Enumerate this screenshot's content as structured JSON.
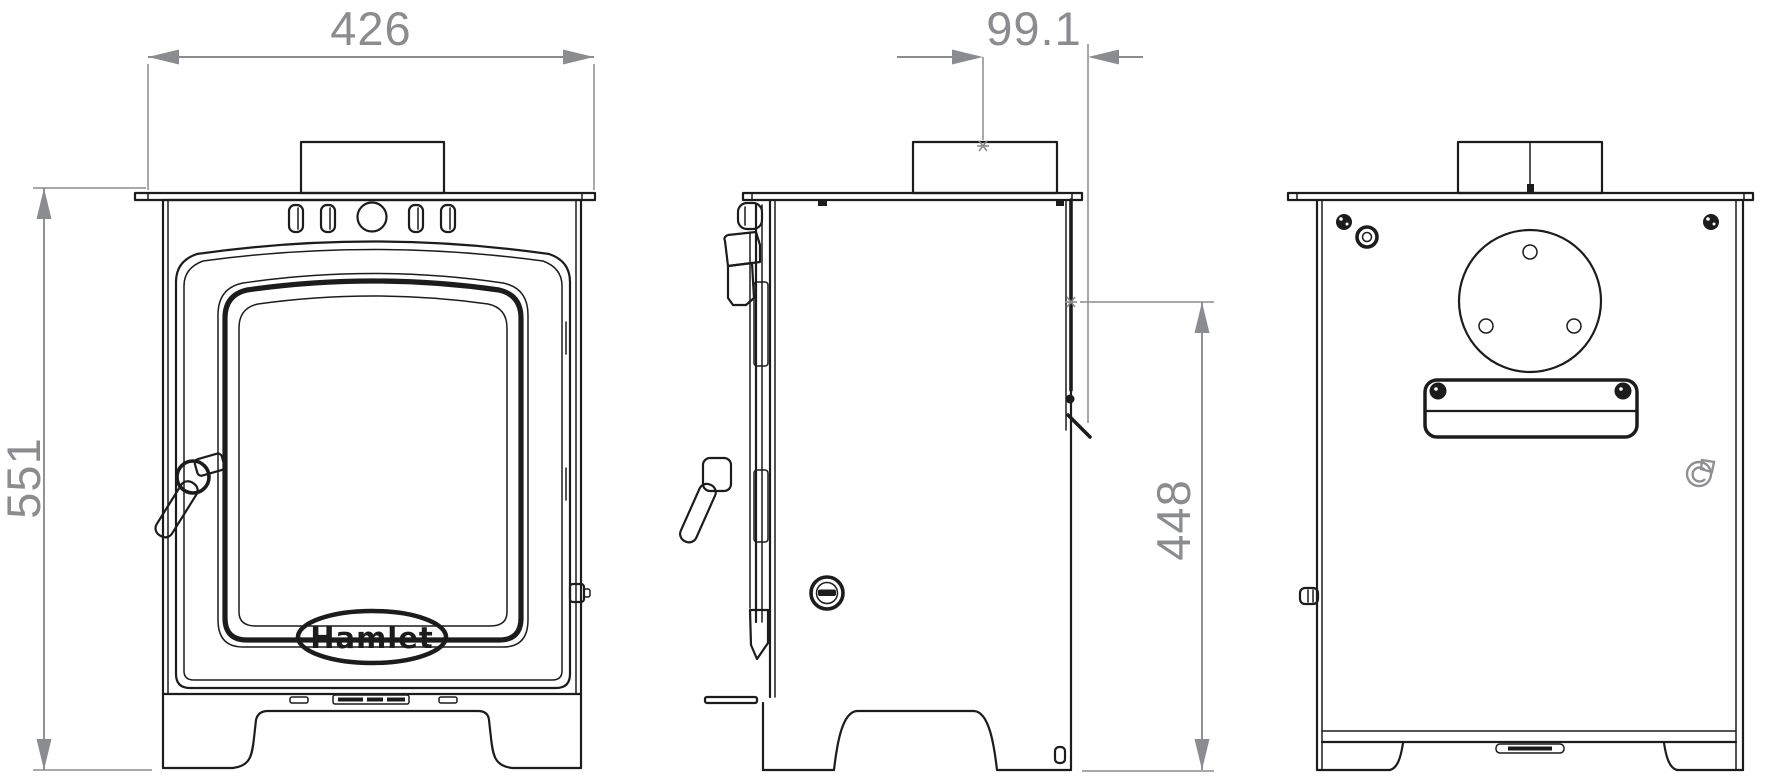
{
  "drawing": {
    "brand_logo": "Hamlet",
    "dimensions": {
      "front_width": {
        "value": "426"
      },
      "front_height": {
        "value": "551"
      },
      "flue_centre_from_back": {
        "value": "99.1"
      },
      "rear_outlet_height": {
        "value": "448"
      }
    },
    "colors": {
      "line": "#1c1c1c",
      "dimension": "#8b8c8f",
      "background": "#ffffff"
    }
  }
}
